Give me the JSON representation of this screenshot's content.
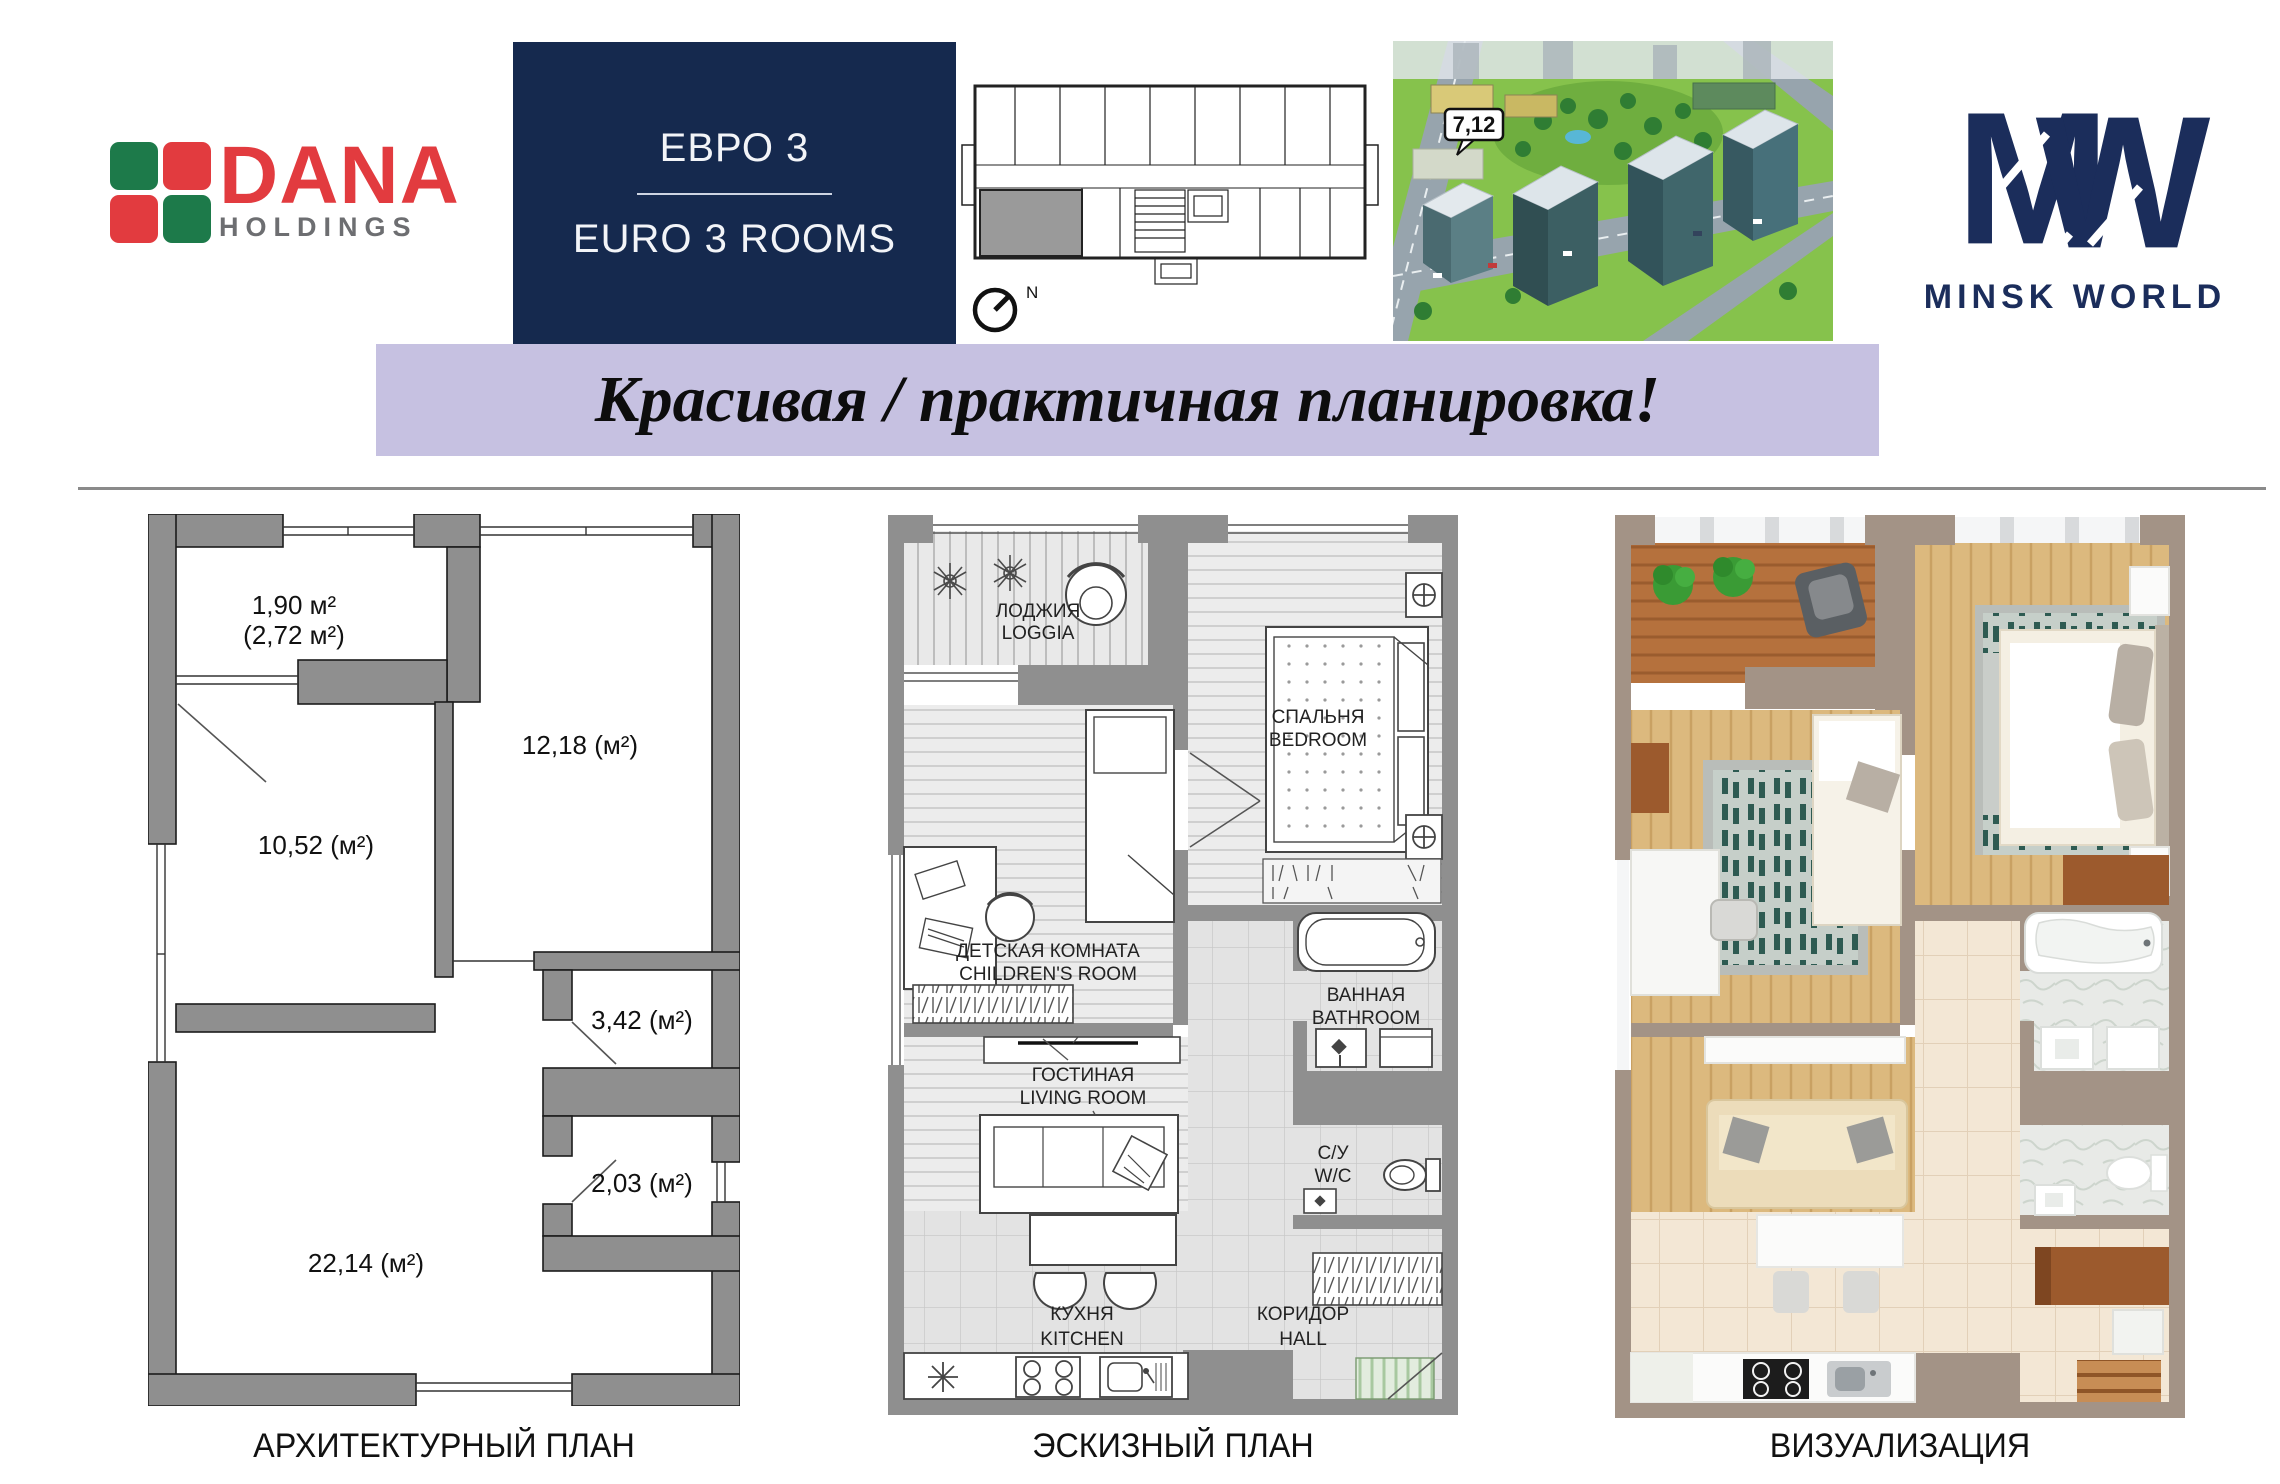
{
  "header": {
    "dana": {
      "name": "DANA",
      "holdings": "HOLDINGS"
    },
    "euro": {
      "title_ru": "ЕВРО 3",
      "title_en": "EURO 3 ROOMS"
    },
    "floor_overview": {
      "compass": "N"
    },
    "aerial": {
      "building_label": "7,12"
    },
    "minsk_world": {
      "monogram_m": "M",
      "monogram_w": "W",
      "label": "MINSK WORLD"
    }
  },
  "banner": {
    "text": "Красивая / практичная планировка!"
  },
  "architectural": {
    "caption": "АРХИТЕКТУРНЫЙ ПЛАН",
    "loggia_area": "1,90 м²",
    "loggia_area_full": "(2,72 м²)",
    "bedroom_area": "12,18 (м²)",
    "children_area": "10,52 (м²)",
    "bathroom_area": "3,42 (м²)",
    "wc_area": "2,03 (м²)",
    "living_area": "22,14 (м²)"
  },
  "sketch": {
    "caption": "ЭСКИЗНЫЙ ПЛАН",
    "loggia_ru": "ЛОДЖИЯ",
    "loggia_en": "LOGGIA",
    "bedroom_ru": "СПАЛЬНЯ",
    "bedroom_en": "BEDROOM",
    "children_ru": "ДЕТСКАЯ КОМНАТА",
    "children_en": "CHILDREN'S ROOM",
    "bathroom_ru": "ВАННАЯ",
    "bathroom_en": "BATHROOM",
    "wc_ru": "С/У",
    "wc_en": "W/C",
    "living_ru": "ГОСТИНАЯ",
    "living_en": "LIVING ROOM",
    "kitchen_ru": "КУХНЯ",
    "kitchen_en": "KITCHEN",
    "hall_ru": "КОРИДОР",
    "hall_en": "HALL"
  },
  "visualization": {
    "caption": "ВИЗУАЛИЗАЦИЯ"
  },
  "colors": {
    "navy": "#15294e",
    "mw_navy": "#1b2d5b",
    "banner_lavender": "#c6c1e1",
    "dana_red": "#e23b3f",
    "dana_green": "#1d7a4a",
    "holdings_gray": "#6d6e71",
    "plan_wall_gray": "#8f8f8f",
    "viz_wall_taupe": "#a39386"
  }
}
